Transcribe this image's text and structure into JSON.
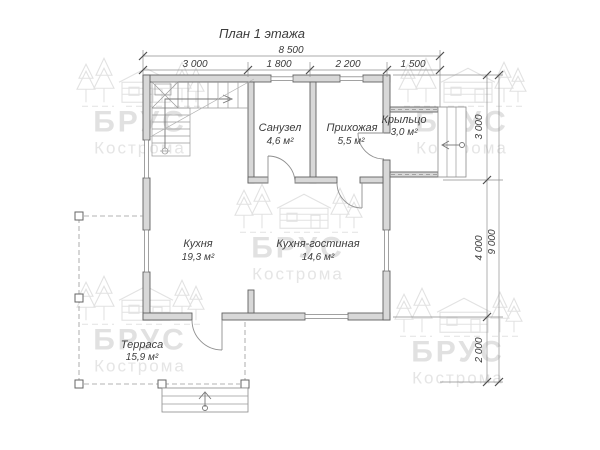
{
  "title": "План 1 этажа",
  "watermark": {
    "brand": "БРУС",
    "city": "Кострома"
  },
  "rooms": [
    {
      "name": "Санузел",
      "area": "4,6 м²"
    },
    {
      "name": "Прихожая",
      "area": "5,5 м²"
    },
    {
      "name": "Крыльцо",
      "area": "3,0 м²"
    },
    {
      "name": "Кухня",
      "area": "19,3 м²"
    },
    {
      "name": "Кухня-гостиная",
      "area": "14,6 м²"
    },
    {
      "name": "Терраса",
      "area": "15,9 м²"
    }
  ],
  "dimensions": {
    "top_total": "8 500",
    "top_segments": [
      "3 000",
      "1 800",
      "2 200",
      "1 500"
    ],
    "right_total": "9 000",
    "right_segments": [
      "3 000",
      "4 000",
      "2 000"
    ]
  },
  "colors": {
    "wall_fill": "#d8d8d8",
    "wall_stroke": "#606060",
    "thin_line": "#9a9a9a",
    "text": "#3c3c3c",
    "watermark": "#e1e1e1",
    "background": "#ffffff"
  }
}
